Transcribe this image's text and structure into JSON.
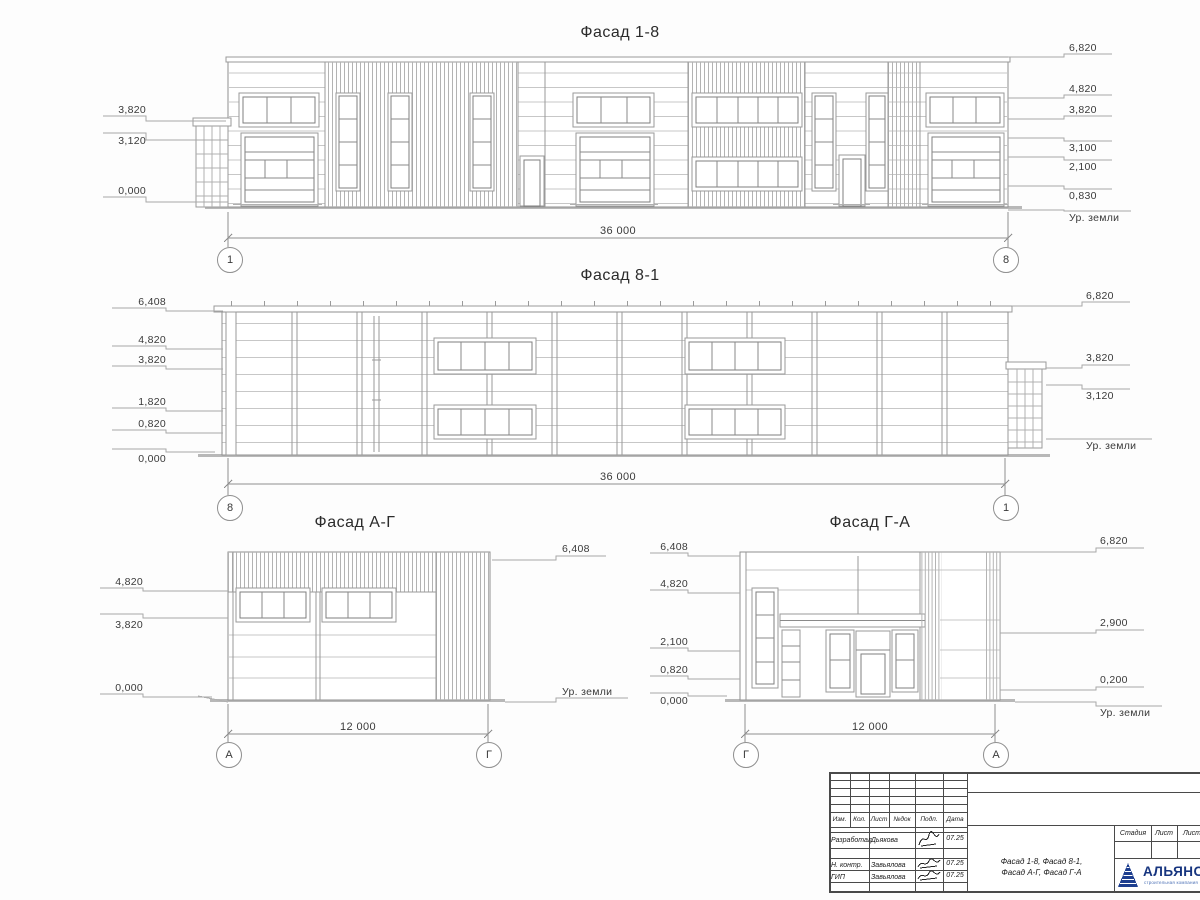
{
  "drawing": {
    "facade_18": {
      "title": "Фасад 1-8",
      "dim": "36 000",
      "axis_left": "1",
      "axis_right": "8",
      "marks_left": [
        "3,820",
        "3,120",
        "0,000"
      ],
      "marks_right": [
        "6,820",
        "4,820",
        "3,820",
        "3,100",
        "2,100",
        "0,830",
        "Ур. земли"
      ]
    },
    "facade_81": {
      "title": "Фасад 8-1",
      "dim": "36 000",
      "axis_left": "8",
      "axis_right": "1",
      "marks_left": [
        "6,408",
        "4,820",
        "3,820",
        "1,820",
        "0,820",
        "0,000"
      ],
      "marks_right": [
        "6,820",
        "3,820",
        "3,120",
        "Ур. земли"
      ]
    },
    "facade_ag": {
      "title": "Фасад А-Г",
      "dim": "12 000",
      "axis_left": "А",
      "axis_right": "Г",
      "marks_left": [
        "4,820",
        "3,820",
        "0,000"
      ],
      "marks_right": [
        "6,408",
        "Ур. земли"
      ]
    },
    "facade_ga": {
      "title": "Фасад Г-А",
      "dim": "12 000",
      "axis_left": "Г",
      "axis_right": "А",
      "marks_left": [
        "6,408",
        "4,820",
        "2,100",
        "0,820",
        "0,000"
      ],
      "marks_right": [
        "6,820",
        "2,900",
        "0,200",
        "Ур. земли"
      ]
    }
  },
  "title_block": {
    "revision_headers": [
      "Изм.",
      "Кол.",
      "Лист",
      "№док",
      "Подп.",
      "Дата"
    ],
    "signature_rows": [
      {
        "role": "Разработал",
        "name": "Дьякова",
        "date": "07.25"
      },
      {
        "role": "Н. контр.",
        "name": "Завьялова",
        "date": "07.25"
      },
      {
        "role": "ГИП",
        "name": "Завьялова",
        "date": "07.25"
      }
    ],
    "doc_title_line1": "Фасад 1-8, Фасад 8-1,",
    "doc_title_line2": "Фасад А-Г, Фасад Г-А",
    "stage_headers": [
      "Стадия",
      "Лист",
      "Лист"
    ],
    "logo_name": "АЛЬЯНС",
    "logo_subtitle": "строительная компания"
  }
}
